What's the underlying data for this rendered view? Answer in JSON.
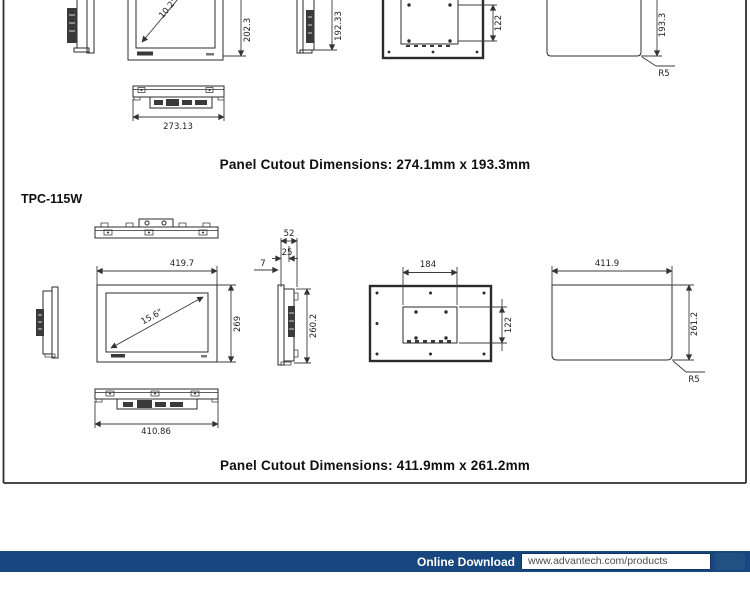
{
  "sections": [
    {
      "heading": "Panel Cutout Dimensions: 274.1mm x 193.3mm",
      "dims": {
        "front_height": "202.3",
        "side_height": "192.33",
        "vesa_height": "122",
        "cutout_height": "193.3",
        "corner_radius": "R5",
        "diagonal": "10.2\"",
        "bottom_width": "273.13"
      }
    },
    {
      "title": "TPC-115W",
      "heading": "Panel Cutout Dimensions: 411.9mm x 261.2mm",
      "dims": {
        "front_width": "419.7",
        "front_height": "269",
        "diagonal": "15.6\"",
        "depth_total": "52",
        "depth_front": "25",
        "depth_bezel": "7",
        "side_height": "260.2",
        "vesa_width": "184",
        "vesa_height": "122",
        "cutout_width": "411.9",
        "cutout_height": "261.2",
        "corner_radius": "R5",
        "bottom_width": "410.86"
      }
    }
  ],
  "footer": {
    "label": "Online Download",
    "url": "www.advantech.com/products",
    "bar_color": "#17477e",
    "accent_color": "#215083"
  }
}
